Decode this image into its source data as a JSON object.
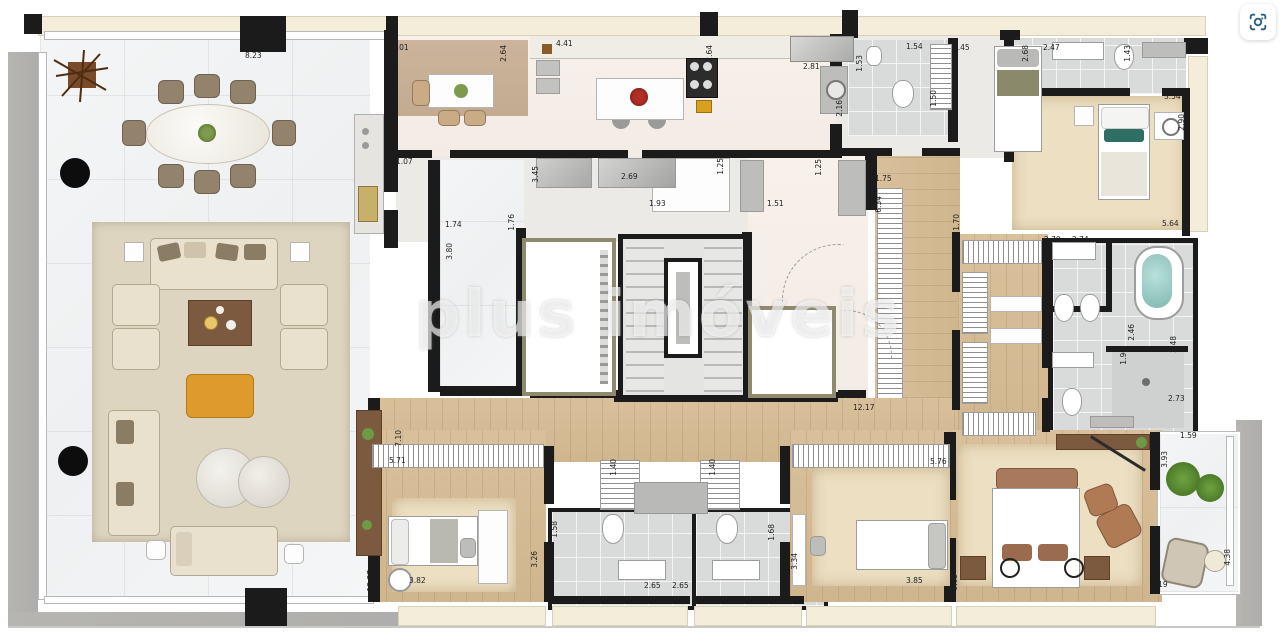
{
  "watermark": {
    "text": "plus imóveis"
  },
  "toolbar": {
    "visual_search_icon": "camera-lens-visual-search"
  },
  "colors": {
    "wall": "#1b1b1b",
    "marble_floor": "#f3f4f5",
    "wood_floor": "#d5bb94",
    "carpet": "#ecdfc2",
    "tan_floor": "#c9b29a",
    "tile_floor": "#d9dada",
    "cream_sill": "#f4edda",
    "terrace_gray": "#b3b2ae",
    "ottoman_orange": "#df9a2e",
    "teal_accent": "#2e6e63",
    "tub_water": "#9ccfc9",
    "watermark_white": "rgba(255,255,255,0.62)",
    "lens_icon_blue": "#2d5f7e"
  },
  "dimensions": [
    {
      "t": "8.23",
      "x": 245,
      "y": 52,
      "v": false
    },
    {
      "t": "3.01",
      "x": 392,
      "y": 44,
      "v": false
    },
    {
      "t": "4.41",
      "x": 556,
      "y": 40,
      "v": false
    },
    {
      "t": "2.81",
      "x": 803,
      "y": 63,
      "v": false
    },
    {
      "t": "1.54",
      "x": 906,
      "y": 43,
      "v": false
    },
    {
      "t": "2.45",
      "x": 953,
      "y": 44,
      "v": false
    },
    {
      "t": "2.47",
      "x": 1043,
      "y": 44,
      "v": false
    },
    {
      "t": "3.54",
      "x": 1164,
      "y": 93,
      "v": false
    },
    {
      "t": "5.64",
      "x": 1162,
      "y": 220,
      "v": false
    },
    {
      "t": "1.07",
      "x": 396,
      "y": 158,
      "v": false
    },
    {
      "t": "1.74",
      "x": 445,
      "y": 221,
      "v": false
    },
    {
      "t": "1.93",
      "x": 649,
      "y": 200,
      "v": false
    },
    {
      "t": "1.51",
      "x": 767,
      "y": 200,
      "v": false
    },
    {
      "t": "1.75",
      "x": 875,
      "y": 175,
      "v": false
    },
    {
      "t": "2.69",
      "x": 621,
      "y": 173,
      "v": false
    },
    {
      "t": "2.70",
      "x": 1044,
      "y": 236,
      "v": false
    },
    {
      "t": "2.74",
      "x": 1072,
      "y": 236,
      "v": false
    },
    {
      "t": "2.73",
      "x": 1168,
      "y": 395,
      "v": false
    },
    {
      "t": "12.17",
      "x": 853,
      "y": 404,
      "v": false
    },
    {
      "t": "1.50",
      "x": 448,
      "y": 387,
      "v": false
    },
    {
      "t": "5.71",
      "x": 389,
      "y": 457,
      "v": false
    },
    {
      "t": "5.76",
      "x": 930,
      "y": 458,
      "v": false
    },
    {
      "t": "3.82",
      "x": 409,
      "y": 577,
      "v": false
    },
    {
      "t": "2.65",
      "x": 644,
      "y": 582,
      "v": false
    },
    {
      "t": "2.65",
      "x": 672,
      "y": 582,
      "v": false
    },
    {
      "t": "3.85",
      "x": 906,
      "y": 577,
      "v": false
    },
    {
      "t": "5.19",
      "x": 1151,
      "y": 581,
      "v": false
    },
    {
      "t": "1.59",
      "x": 1180,
      "y": 432,
      "v": false
    },
    {
      "t": "2.64",
      "x": 500,
      "y": 45,
      "v": true
    },
    {
      "t": "2.64",
      "x": 706,
      "y": 45,
      "v": true
    },
    {
      "t": "1.53",
      "x": 856,
      "y": 55,
      "v": true
    },
    {
      "t": "2.16",
      "x": 836,
      "y": 100,
      "v": true
    },
    {
      "t": "2.68",
      "x": 1022,
      "y": 45,
      "v": true
    },
    {
      "t": "1.43",
      "x": 1124,
      "y": 45,
      "v": true
    },
    {
      "t": "2.90",
      "x": 1178,
      "y": 114,
      "v": true
    },
    {
      "t": "1.50",
      "x": 930,
      "y": 90,
      "v": true
    },
    {
      "t": "3.45",
      "x": 532,
      "y": 166,
      "v": true
    },
    {
      "t": "1.25",
      "x": 717,
      "y": 158,
      "v": true
    },
    {
      "t": "1.25",
      "x": 815,
      "y": 159,
      "v": true
    },
    {
      "t": "6.34",
      "x": 875,
      "y": 196,
      "v": true
    },
    {
      "t": "1.70",
      "x": 953,
      "y": 214,
      "v": true
    },
    {
      "t": "1.76",
      "x": 508,
      "y": 214,
      "v": true
    },
    {
      "t": "3.80",
      "x": 446,
      "y": 243,
      "v": true
    },
    {
      "t": "2.46",
      "x": 1128,
      "y": 324,
      "v": true
    },
    {
      "t": "1.90",
      "x": 1120,
      "y": 348,
      "v": true
    },
    {
      "t": "2.48",
      "x": 1170,
      "y": 336,
      "v": true
    },
    {
      "t": "7.10",
      "x": 395,
      "y": 430,
      "v": true
    },
    {
      "t": "13.37",
      "x": 367,
      "y": 570,
      "v": true
    },
    {
      "t": "1.40",
      "x": 610,
      "y": 459,
      "v": true
    },
    {
      "t": "1.40",
      "x": 709,
      "y": 459,
      "v": true
    },
    {
      "t": "1.58",
      "x": 551,
      "y": 521,
      "v": true
    },
    {
      "t": "3.26",
      "x": 531,
      "y": 551,
      "v": true
    },
    {
      "t": "1.68",
      "x": 768,
      "y": 524,
      "v": true
    },
    {
      "t": "3.34",
      "x": 791,
      "y": 553,
      "v": true
    },
    {
      "t": "8.65",
      "x": 951,
      "y": 574,
      "v": true
    },
    {
      "t": "3.93",
      "x": 1161,
      "y": 451,
      "v": true
    },
    {
      "t": "4.38",
      "x": 1224,
      "y": 549,
      "v": true
    }
  ]
}
